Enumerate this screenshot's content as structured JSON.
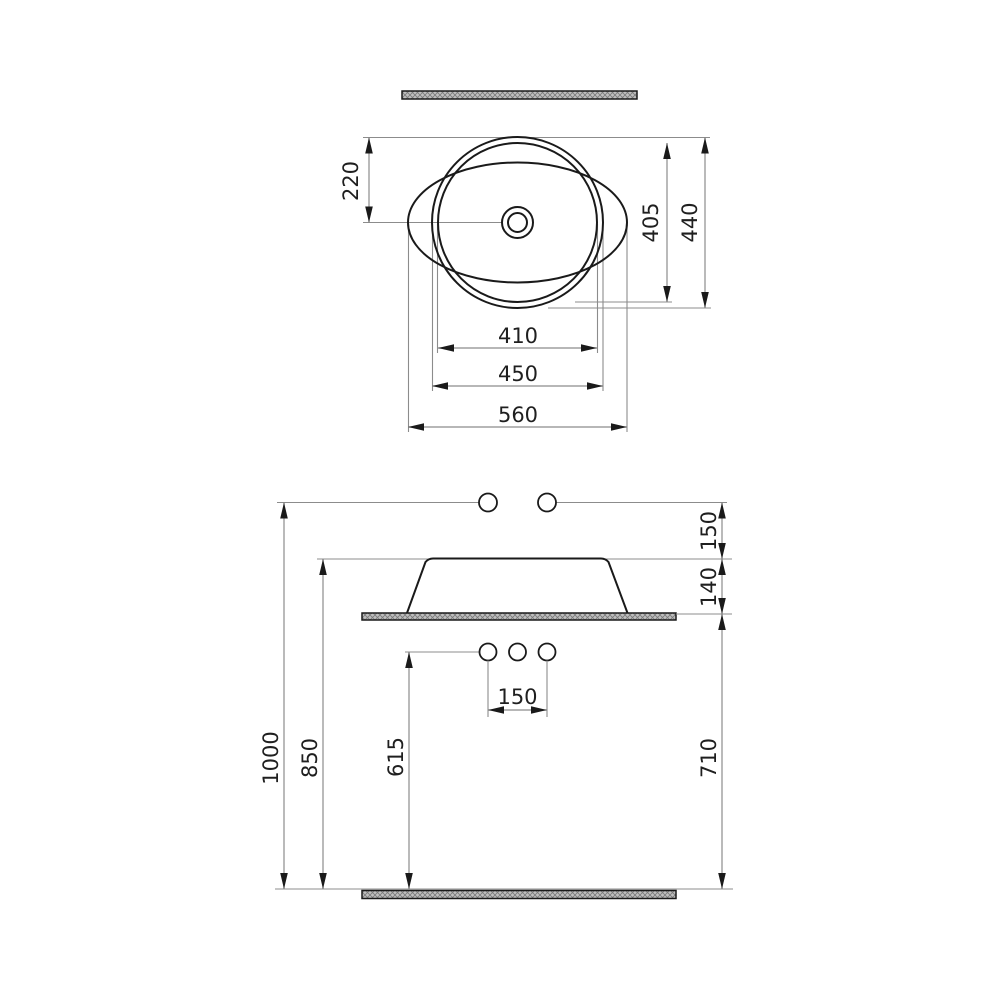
{
  "drawing": {
    "kind": "technical dimension drawing",
    "views": [
      "top view",
      "side elevation"
    ]
  },
  "colors": {
    "background": "#ffffff",
    "geometry_line": "#1a1a1a",
    "dimension_line": "#8c8c8c",
    "arrowhead": "#1a1a1a",
    "label_text": "#1f1f1f",
    "hatch_fill": "#bfbfbf",
    "hatch_stroke": "#7a7a7a"
  },
  "top_view": {
    "dim_center_offset": "220",
    "dim_inner_height": "405",
    "dim_overall_height": "440",
    "dim_inner_width": "410",
    "dim_bowl_width": "450",
    "dim_overall_width": "560"
  },
  "side_view": {
    "dim_rim_to_line": "150",
    "dim_basin_height": "140",
    "dim_total_height": "1000",
    "dim_rim_height": "850",
    "dim_holes_height": "615",
    "dim_hole_spacing": "150",
    "dim_counter_height": "710"
  }
}
